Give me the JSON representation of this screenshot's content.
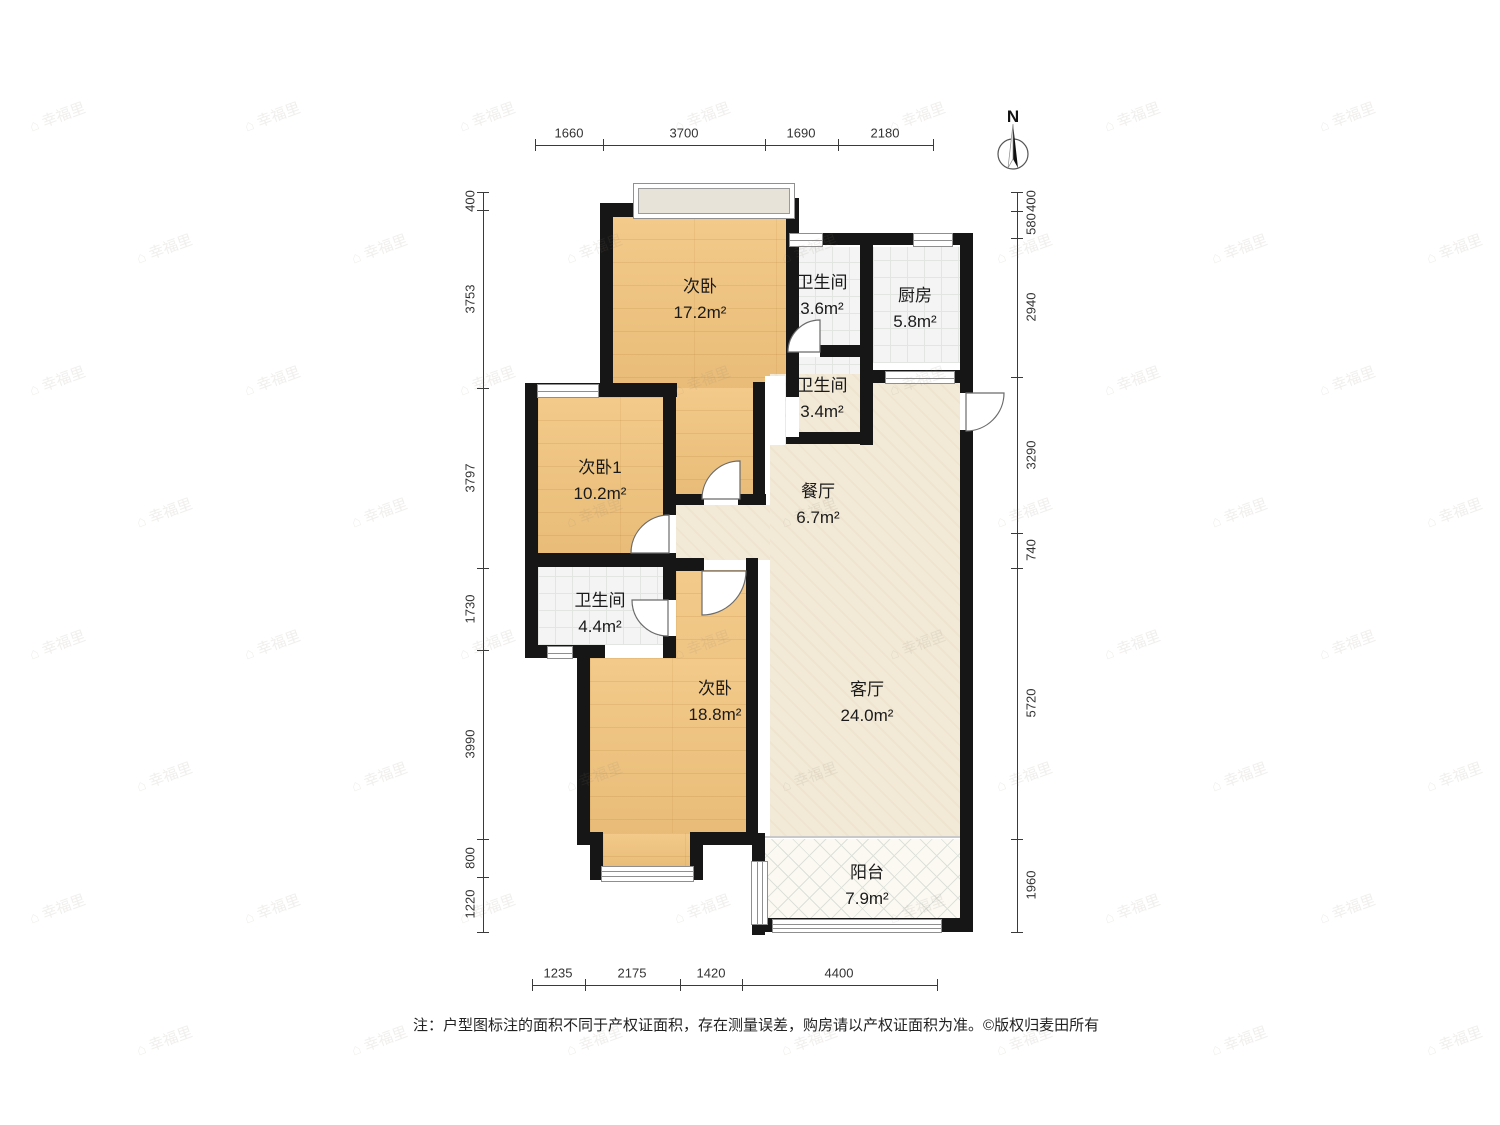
{
  "compass": {
    "label": "N"
  },
  "rooms": [
    {
      "name": "次卧",
      "area": "17.2m²"
    },
    {
      "name": "卫生间",
      "area": "3.6m²"
    },
    {
      "name": "厨房",
      "area": "5.8m²"
    },
    {
      "name": "卫生间",
      "area": "3.4m²"
    },
    {
      "name": "次卧1",
      "area": "10.2m²"
    },
    {
      "name": "餐厅",
      "area": "6.7m²"
    },
    {
      "name": "卫生间",
      "area": "4.4m²"
    },
    {
      "name": "次卧",
      "area": "18.8m²"
    },
    {
      "name": "客厅",
      "area": "24.0m²"
    },
    {
      "name": "阳台",
      "area": "7.9m²"
    }
  ],
  "dimensions": {
    "top": [
      "1660",
      "3700",
      "1690",
      "2180"
    ],
    "bottom": [
      "1235",
      "2175",
      "1420",
      "4400"
    ],
    "left": [
      "400",
      "3753",
      "3797",
      "1730",
      "3990",
      "800",
      "1220"
    ],
    "right": [
      "400",
      "580",
      "2940",
      "3290",
      "740",
      "5720",
      "1960"
    ]
  },
  "footer": {
    "note": "注：户型图标注的面积不同于产权证面积，存在测量误差，购房请以产权证面积为准。",
    "copyright": "©版权归麦田所有"
  },
  "watermark": {
    "glyph": "⌂",
    "text": "幸福里"
  },
  "colors": {
    "wall": "#161616",
    "bedroom": "#f2c47d",
    "tile": "#f3f4f3",
    "living": "#f2e9d7",
    "balcony": "#fbf9f2",
    "bay": "#e7e3d8",
    "line": "#8f8f8f",
    "dim": "#3a3a3a",
    "text": "#1a1a1a"
  }
}
